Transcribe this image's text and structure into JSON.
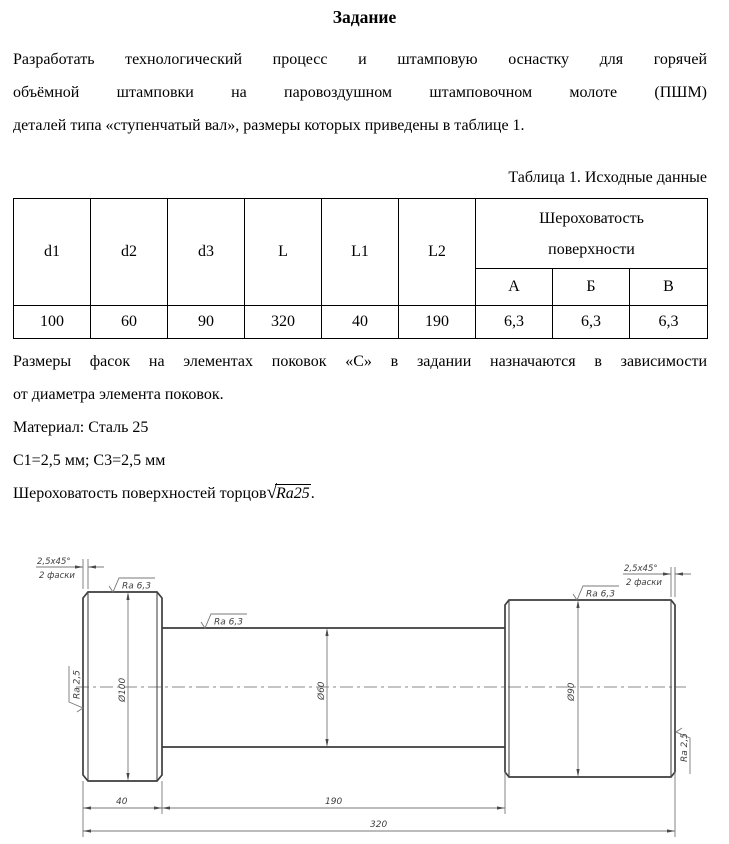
{
  "title": "Задание",
  "intro": {
    "line1": "Разработать технологический процесс и штамповую оснастку для горячей",
    "line2": "объёмной штамповки на паровоздушном штамповочном молоте (ПШМ)",
    "line3": "деталей типа «ступенчатый вал», размеры которых приведены в таблице 1."
  },
  "table_caption": "Таблица 1. Исходные данные",
  "table": {
    "headers": [
      "d1",
      "d2",
      "d3",
      "L",
      "L1",
      "L2"
    ],
    "group_header_line1": "Шероховатость",
    "group_header_line2": "поверхности",
    "sub_headers": [
      "А",
      "Б",
      "В"
    ],
    "values": [
      "100",
      "60",
      "90",
      "320",
      "40",
      "190",
      "6,3",
      "6,3",
      "6,3"
    ]
  },
  "notes": {
    "chamfer_note_line1": "Размеры фасок на элементах поковок «С» в задании назначаются в зависимости",
    "chamfer_note_line2": "от диаметра элемента поковок.",
    "material": "Материал: Сталь 25",
    "chamfer_values": "С1=2,5 мм; С3=2,5 мм",
    "roughness_prefix": "Шероховатость поверхностей торцов",
    "roughness_radical": "√",
    "roughness_radicand": "Ra25",
    "roughness_suffix": "."
  },
  "drawing": {
    "chamfer_label_top": "2,5x45°",
    "chamfer_label_bottom": "2 фаски",
    "ra_63": "Ra 6,3",
    "ra_25": "Ra 2,5",
    "dia_1": "Ø100",
    "dia_2": "Ø60",
    "dia_3": "Ø90",
    "len_1": "40",
    "len_2": "190",
    "len_total": "320"
  },
  "colors": {
    "text": "#000000",
    "drawing_outline": "#3d3d3d",
    "drawing_thin_line": "#787878"
  }
}
